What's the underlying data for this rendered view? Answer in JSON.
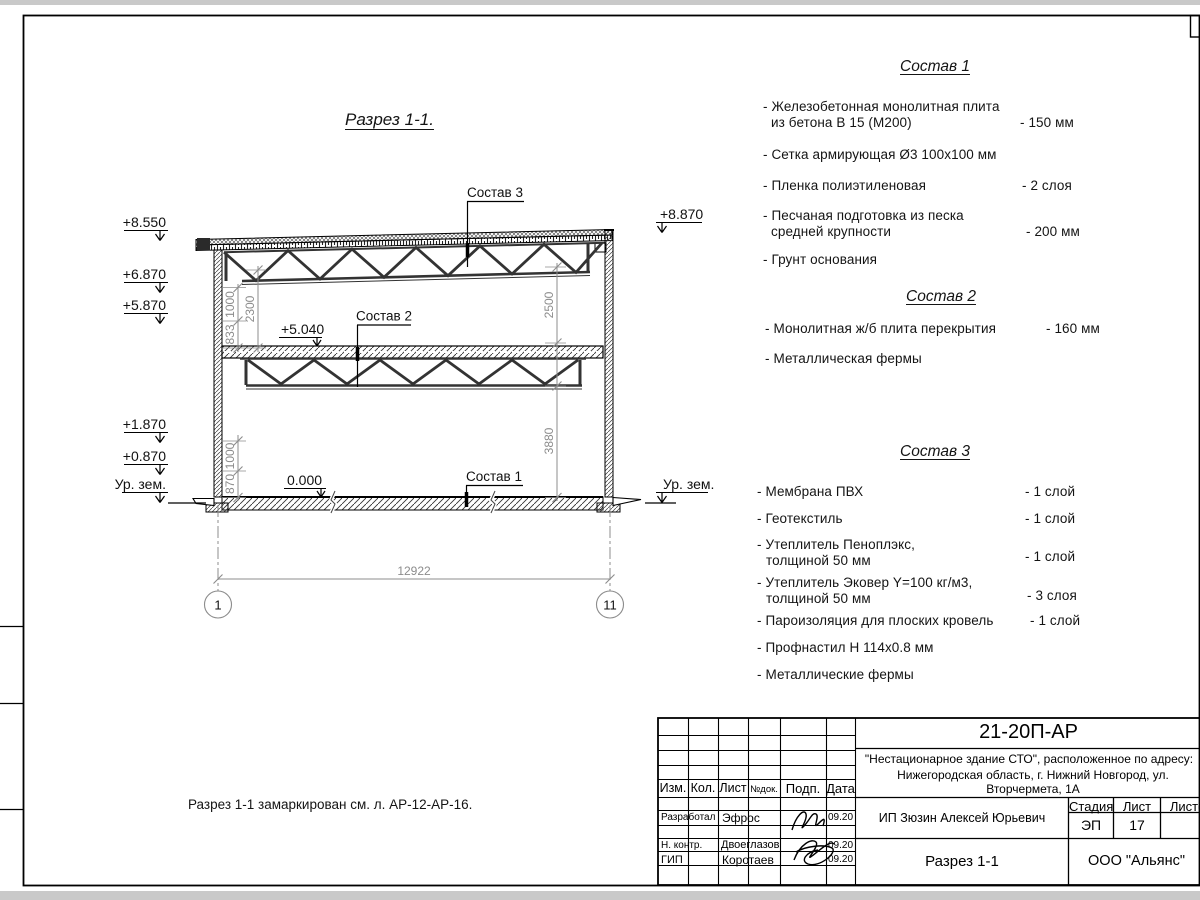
{
  "page": {
    "section_title": "Разрез 1-1.",
    "note": "Разрез 1-1 замаркирован см. л. АР-12-АР-16."
  },
  "drawing": {
    "leader_sostav3": "Состав 3",
    "leader_sostav2": "Состав 2",
    "leader_sostav1": "Состав 1",
    "elev": {
      "e8550": "+8.550",
      "e6870": "+6.870",
      "e5870": "+5.870",
      "e1870": "+1.870",
      "e0870": "+0.870",
      "e8870": "+8.870",
      "e5040": "+5.040",
      "zero": "0.000"
    },
    "ground_left": "Ур. зем.",
    "ground_right": "Ур. зем.",
    "dims": {
      "d833": "833",
      "d1000a": "1000",
      "d2300": "2300",
      "d1000b": "1000",
      "d870": "870",
      "d2500": "2500",
      "d3880": "3880",
      "d12922": "12922"
    },
    "grid": {
      "a1": "1",
      "a11": "11"
    }
  },
  "compositions": [
    {
      "title": "Состав 1",
      "items": [
        {
          "line1": "- Железобетонная  монолитная плита",
          "line2": "из бетона В 15 (М200)",
          "value": "- 150 мм"
        },
        {
          "line1": "- Сетка армирующая Ø3 100х100 мм",
          "line2": "",
          "value": ""
        },
        {
          "line1": "- Пленка полиэтиленовая",
          "line2": "",
          "value": "-  2 слоя"
        },
        {
          "line1": "- Песчаная подготовка из песка",
          "line2": "средней крупности",
          "value": "- 200 мм"
        },
        {
          "line1": "- Грунт основания",
          "line2": "",
          "value": ""
        }
      ]
    },
    {
      "title": "Состав 2",
      "items": [
        {
          "line1": "- Монолитная ж/б плита перекрытия",
          "line2": "",
          "value": "- 160 мм"
        },
        {
          "line1": "- Металлическая фермы",
          "line2": "",
          "value": ""
        }
      ]
    },
    {
      "title": "Состав 3",
      "items": [
        {
          "line1": "- Мембрана ПВХ",
          "line2": "",
          "value": "- 1 слой"
        },
        {
          "line1": "- Геотекстиль",
          "line2": "",
          "value": "- 1 слой"
        },
        {
          "line1": "- Утеплитель Пеноплэкс,",
          "line2": "толщиной 50 мм",
          "value": "- 1 слой"
        },
        {
          "line1": "- Утеплитель Эковер Y=100 кг/м3,",
          "line2": "толщиной 50 мм",
          "value": "- 3 слоя"
        },
        {
          "line1": "- Пароизоляция для плоских кровель",
          "line2": "",
          "value": "- 1 слой"
        },
        {
          "line1": "- Профнастил Н 114х0.8 мм",
          "line2": "",
          "value": ""
        },
        {
          "line1": "- Металлические фермы",
          "line2": "",
          "value": ""
        }
      ]
    }
  ],
  "titleblock": {
    "code": "21-20П-АР",
    "object_line1": "\"Нестационарное здание СТО\", расположенное по адресу:",
    "object_line2": "Нижегородская область, г. Нижний Новгород, ул. Вторчермета, 1А",
    "columns": {
      "izm": "Изм.",
      "kol": "Кол.",
      "list": "Лист",
      "ndok": "№док.",
      "podp": "Подп.",
      "data": "Дата"
    },
    "rows": [
      {
        "role": "Разработал",
        "name": "Эфрос",
        "date": "09.20"
      },
      {
        "role": "Н. контр.",
        "name": "Двоеглазов",
        "date": "09.20"
      },
      {
        "role": "ГИП",
        "name": "Коротаев",
        "date": "09.20"
      }
    ],
    "client": "ИП Зюзин Алексей Юрьевич",
    "stage_label": "Стадия",
    "sheet_label": "Лист",
    "sheets_label": "Листов",
    "stage": "ЭП",
    "sheet_no": "17",
    "doc_title": "Разрез 1-1",
    "company": "ООО \"Альянс\""
  }
}
